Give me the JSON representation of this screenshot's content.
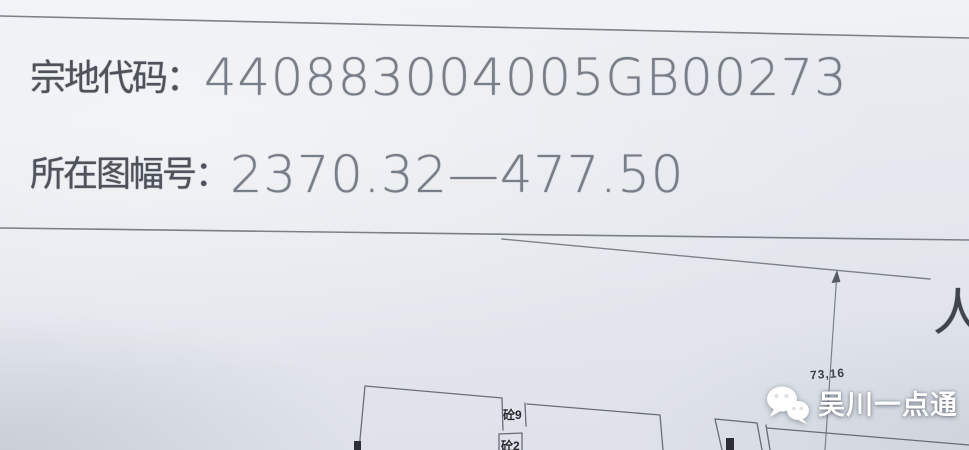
{
  "photo": {
    "header": {
      "row1": {
        "label": "宗地代码：",
        "value": "440883004005GB00273"
      },
      "row2": {
        "label": "所在图幅号：",
        "value": "2370.32—477.50"
      }
    },
    "map": {
      "dimension_label": "73,16",
      "road_character": "人",
      "building_label_top": "砼9",
      "building_label_bottom": "砼2"
    },
    "watermark": {
      "text": "吴川一点通",
      "icon": "wechat-icon"
    },
    "colors": {
      "paper": "#e5e8ed",
      "ink_label": "#4e535b",
      "ink_value": "#787e87",
      "map_line": "#71767e",
      "marker": "#2c3036",
      "watermark_text": "#ffffff"
    }
  }
}
